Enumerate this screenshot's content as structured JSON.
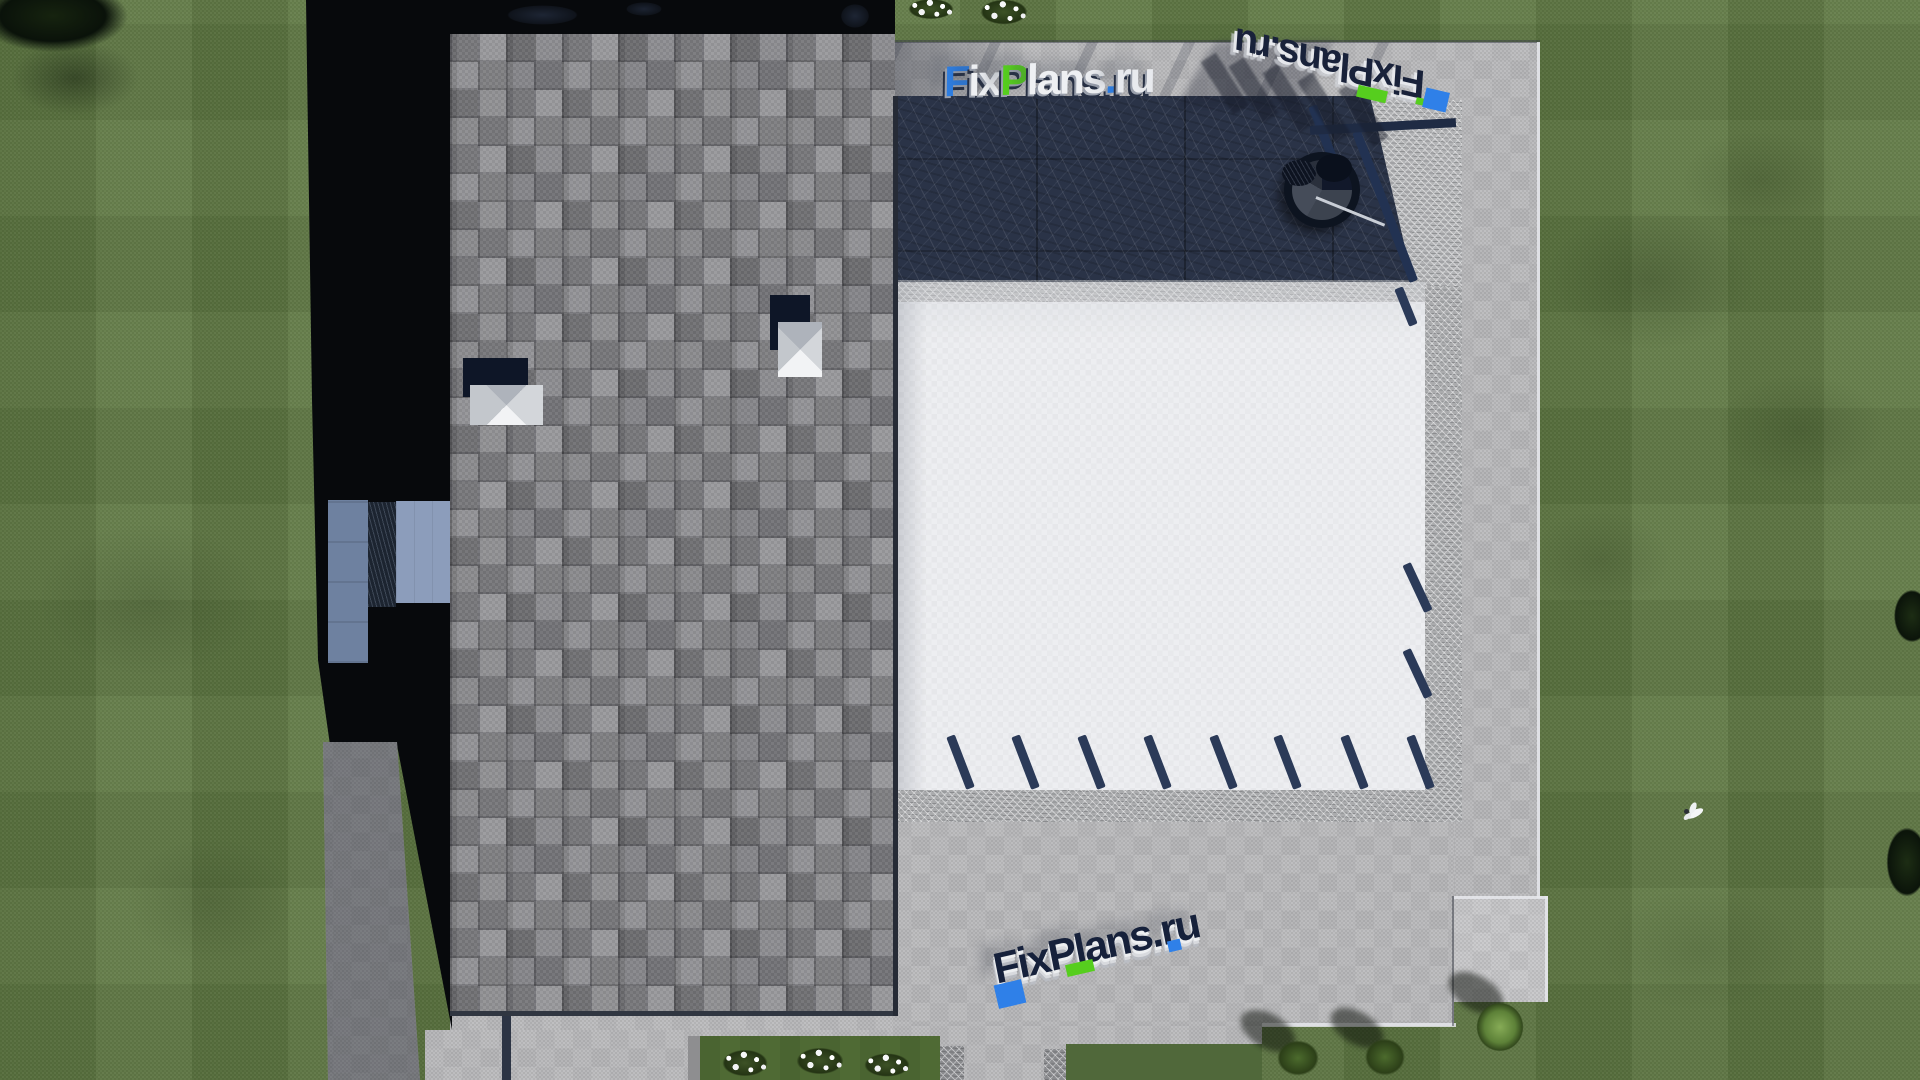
{
  "scene": {
    "type": "aerial-architectural-render",
    "description": "Top-down 3D render of a modern house: gray square-shingle roof, white flat roof with navy pergola beams, dark stone terrace with hanging chair, concrete walkways and apron, striped mowed lawn, flower shrubs and a white bird in flight; long building shadow cast to the left",
    "objects": {
      "shingle_roof": "gray shingled roof with two skylights",
      "flat_roof": "white flat roof with pergola beams",
      "stone_terrace": "dark blue stone terrace",
      "hanging_chair": "round hanging chair on terrace",
      "lawn": "striped mowed lawn",
      "bird": "white bird in flight",
      "walkways": "concrete paths and apron",
      "flower_beds": "planting beds with white flowering shrubs",
      "house_shadow": "building shadow cast to the left",
      "side_patio": "small blue-gray patio in the shadow"
    }
  },
  "watermarks": {
    "top": {
      "segments": [
        {
          "text": "F",
          "color": "#2e7ee2"
        },
        {
          "text": "ix",
          "color": "#eef0f3"
        },
        {
          "text": "P",
          "color": "#56ce1e"
        },
        {
          "text": "lans",
          "color": "#eef0f3"
        },
        {
          "text": ".",
          "color": "#2e7ee2"
        },
        {
          "text": "ru",
          "color": "#e8eaee"
        }
      ]
    },
    "mirrored": {
      "text": "FixPlans.ru"
    },
    "bottom": {
      "text": "FixPlans.ru"
    }
  },
  "colors": {
    "lawn_green": "#5f7843",
    "shingle_gray": "#8d8d91",
    "flat_roof_white": "#edeef1",
    "terrace_navy": "#2a3347",
    "concrete_gray": "#b8b8ba",
    "shadow_black": "#07090c",
    "accent_blue": "#2e7ee2",
    "accent_green": "#56ce1e"
  }
}
